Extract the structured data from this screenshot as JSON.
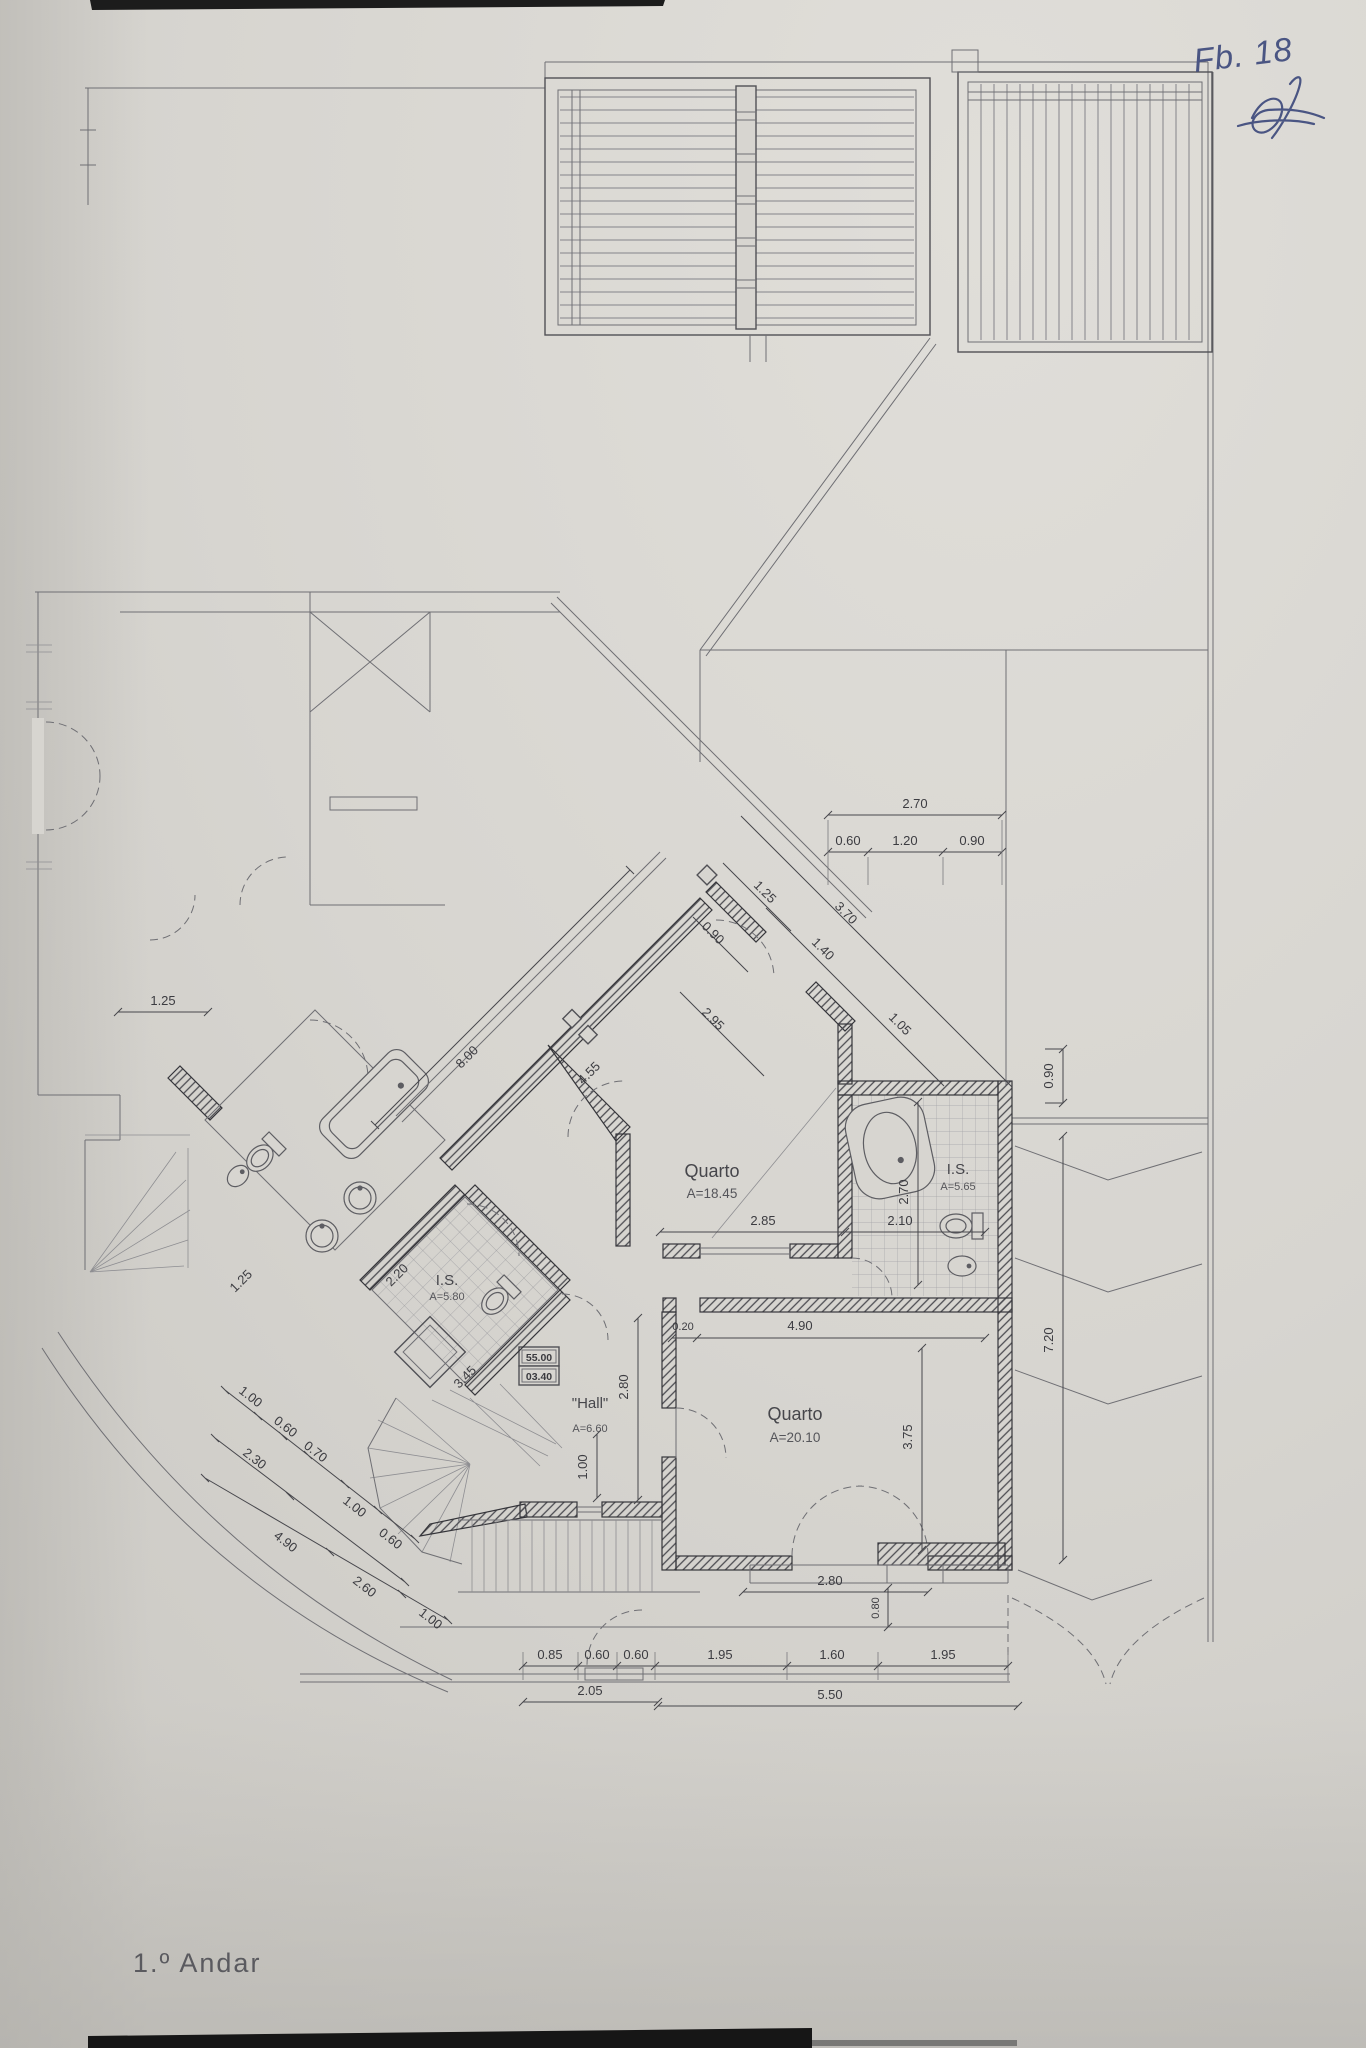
{
  "meta": {
    "title": "1.º Andar",
    "handwritten_note": "Fb. 18"
  },
  "rooms": {
    "quarto1": {
      "name": "Quarto",
      "area": "A=18.45"
    },
    "quarto2": {
      "name": "Quarto",
      "area": "A=20.10"
    },
    "is1": {
      "name": "I.S.",
      "area": "A=5.80"
    },
    "is2": {
      "name": "I.S.",
      "area": "A=5.65"
    },
    "hall": {
      "name": "\"Hall\"",
      "area": "A=6.60"
    }
  },
  "levels_box": {
    "upper": "55.00",
    "lower": "03.40"
  },
  "dims": {
    "t270": "2.70",
    "t060": "0.60",
    "t120": "1.20",
    "t090": "0.90",
    "ne125": "1.25",
    "ne370": "3.70",
    "ne140": "1.40",
    "ne105": "1.05",
    "ne090": "0.90",
    "ne295": "2.95",
    "c800": "8.00",
    "c455": "4.55",
    "q18_285": "2.85",
    "is2_210": "2.10",
    "is2_270": "2.70",
    "is1_220": "2.20",
    "is1_345": "3.45",
    "is1_125": "1.25",
    "q20_020": "0.20",
    "q20_490": "4.90",
    "q20_375": "3.75",
    "hall_280": "2.80",
    "hall_100": "1.00",
    "balc_280": "2.80",
    "balc_080": "0.80",
    "b085": "0.85",
    "b060a": "0.60",
    "b060b": "0.60",
    "b195a": "1.95",
    "b160": "1.60",
    "b195b": "1.95",
    "b205": "2.05",
    "b550": "5.50",
    "r090": "0.90",
    "r720": "7.20",
    "l100a": "1.00",
    "l060a": "0.60",
    "l070": "0.70",
    "l230": "2.30",
    "l100b": "1.00",
    "l060b": "0.60",
    "l490": "4.90",
    "l260": "2.60",
    "l100c": "1.00",
    "l125": "1.25"
  }
}
